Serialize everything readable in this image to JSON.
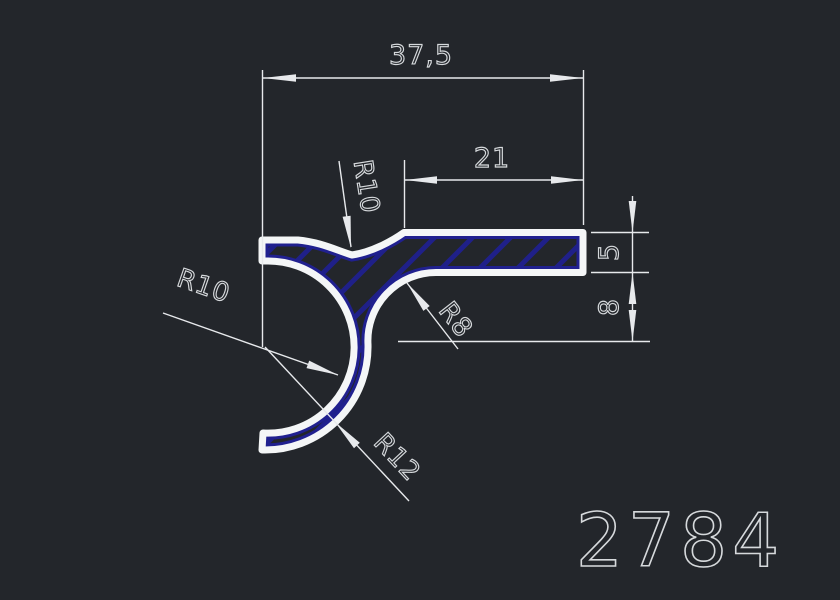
{
  "drawing": {
    "type": "cad-profile-cross-section",
    "profile_number": "2784",
    "dimensions": {
      "overall_width": "37,5",
      "arm_length": "21",
      "arm_thickness": "5",
      "notch_depth": "8",
      "radius_top_fillet": "R10",
      "radius_hook_inner": "R10",
      "radius_arm_fillet": "R8",
      "radius_hook_outer": "R12"
    },
    "colors": {
      "background": "#23262b",
      "outline": "#f4f6f7",
      "dimension": "#e7e9ec",
      "text": "#d6d9dc",
      "hatch": "#20208f"
    }
  }
}
